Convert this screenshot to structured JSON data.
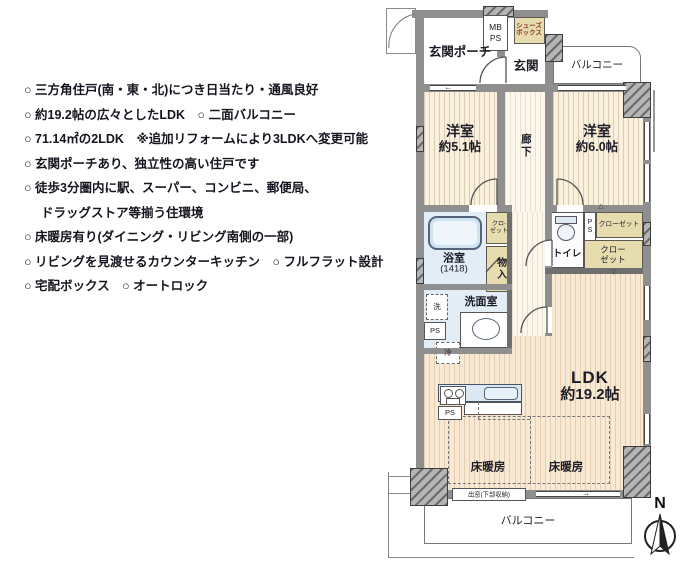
{
  "features": {
    "lines": [
      "○ 三方角住戸(南・東・北)につき日当たり・通風良好",
      "○ 約19.2帖の広々としたLDK　○ 二面バルコニー",
      "○ 71.14㎡の2LDK　※追加リフォームにより3LDKへ変更可能",
      "○ 玄関ポーチあり、独立性の高い住戸です",
      "○ 徒歩3分圏内に駅、スーパー、コンビニ、郵便局、",
      "ドラッグストア等揃う住環境",
      "○ 床暖房有り(ダイニング・リビング南側の一部)",
      "○ リビングを見渡せるカウンターキッチン　○ フルフラット設計",
      "○ 宅配ボックス　○ オートロック"
    ]
  },
  "plan": {
    "labels": {
      "porch": "玄関ポーチ",
      "mb": "MB",
      "ps_meter": "PS",
      "shoes1": "シューズ",
      "shoes2": "ボックス",
      "genkan": "玄関",
      "balcony_top": "バルコニー",
      "bed1_name": "洋室",
      "bed1_size": "約5.1帖",
      "bed2_name": "洋室",
      "bed2_size": "約6.0帖",
      "corridor": "廊下",
      "bath_name": "浴室",
      "bath_size": "(1418)",
      "closet_s1": "クロ-",
      "closet_s2": "ゼット",
      "monoire": "物入",
      "toilet": "トイレ",
      "ps_v1": "P",
      "ps_v2": "S",
      "closet_h": "クローゼット",
      "closet_b1": "クロー",
      "closet_b2": "ゼット",
      "wash": "洗",
      "senmen": "洗面室",
      "ps_left": "PS",
      "rei": "冷",
      "ldk_name": "LDK",
      "ldk_size": "約19.2帖",
      "ps_kitchen": "PS",
      "floorheat_left": "床暖房",
      "floorheat_right": "床暖房",
      "demado": "出窓(下部収納)",
      "balcony_bottom": "バルコニー",
      "compass_n": "N"
    },
    "colors": {
      "room_cream": "#f9f1de",
      "ldk_peach": "#f8e9d5",
      "closet_beige": "#e7dcae",
      "wet_blue": "#e2edf5",
      "wall_gray": "#8f8f8f",
      "text_dark": "#15151f",
      "shoes_text_red": "#8a3a28"
    }
  }
}
